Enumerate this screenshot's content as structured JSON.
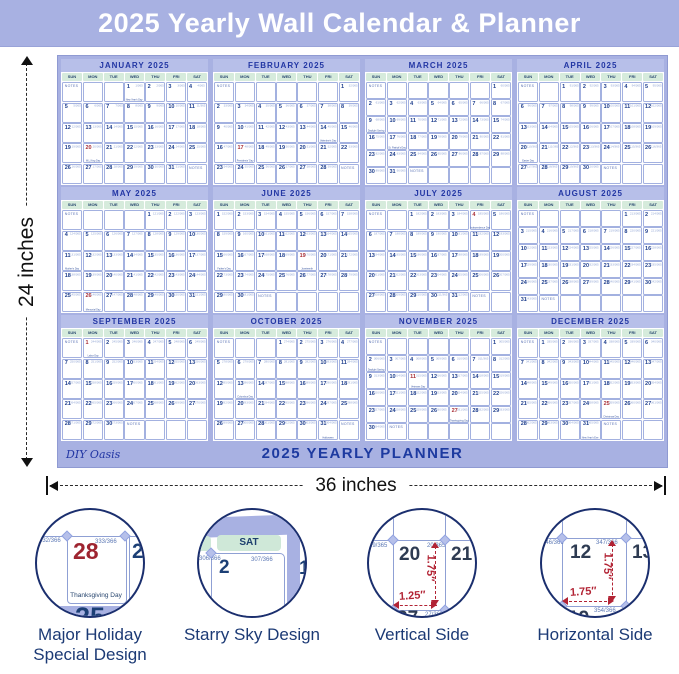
{
  "header": {
    "title": "2025 Yearly Wall Calendar & Planner"
  },
  "poster": {
    "brand": "DIY Oasis",
    "footer": "2025 YEARLY PLANNER",
    "notes_label": "NOTES",
    "year_days": 365,
    "day_headers": [
      "SUN",
      "MON",
      "TUE",
      "WED",
      "THU",
      "FRI",
      "SAT"
    ],
    "months": [
      {
        "label": "JANUARY 2025",
        "days": 31,
        "start": 3,
        "red": [
          20
        ],
        "holidays": {
          "1": "New Year's Day",
          "20": "M.L.King Day"
        }
      },
      {
        "label": "FEBRUARY 2025",
        "days": 28,
        "start": 6,
        "red": [
          17
        ],
        "holidays": {
          "14": "Valentine's Day",
          "17": "Presidents' Day"
        }
      },
      {
        "label": "MARCH 2025",
        "days": 31,
        "start": 6,
        "red": [],
        "holidays": {
          "9": "Daylight Saving",
          "17": "St. Patrick's Day"
        }
      },
      {
        "label": "APRIL 2025",
        "days": 30,
        "start": 2,
        "red": [],
        "holidays": {
          "20": "Easter Day"
        }
      },
      {
        "label": "MAY 2025",
        "days": 31,
        "start": 4,
        "red": [
          26
        ],
        "holidays": {
          "11": "Mother's Day",
          "26": "Memorial Day"
        }
      },
      {
        "label": "JUNE 2025",
        "days": 30,
        "start": 0,
        "red": [
          19
        ],
        "holidays": {
          "15": "Father's Day",
          "19": "Juneteenth"
        }
      },
      {
        "label": "JULY 2025",
        "days": 31,
        "start": 2,
        "red": [
          4
        ],
        "holidays": {
          "4": "Independence Day"
        }
      },
      {
        "label": "AUGUST 2025",
        "days": 31,
        "start": 5,
        "red": [],
        "holidays": {}
      },
      {
        "label": "SEPTEMBER 2025",
        "days": 30,
        "start": 1,
        "red": [
          1
        ],
        "holidays": {
          "1": "Labor Day"
        }
      },
      {
        "label": "OCTOBER 2025",
        "days": 31,
        "start": 3,
        "red": [],
        "holidays": {
          "13": "Columbus Day",
          "31": "Halloween"
        }
      },
      {
        "label": "NOVEMBER 2025",
        "days": 30,
        "start": 6,
        "red": [
          11,
          27
        ],
        "holidays": {
          "2": "Daylight Saving",
          "11": "Veterans Day",
          "27": "Thanksgiving Day"
        }
      },
      {
        "label": "DECEMBER 2025",
        "days": 31,
        "start": 1,
        "red": [
          25
        ],
        "holidays": {
          "25": "Christmas Day",
          "31": "New Year's Eve"
        }
      }
    ]
  },
  "dimensions": {
    "width_label": "36 inches",
    "height_label": "24 inches"
  },
  "features": [
    {
      "label_lines": [
        "Major Holiday",
        "Special Design"
      ],
      "content": {
        "frac_left": "332/366",
        "frac_right": "333/366",
        "red_day": "28",
        "next_day": "29",
        "holiday": "Thanksgiving Day",
        "partial_day": "25"
      }
    },
    {
      "label_lines": [
        "Starry Sky Design"
      ],
      "content": {
        "day_pill": "SAT",
        "main_day": "2",
        "partial_day": "1",
        "frac_left": "306/366",
        "frac_right": "307/366",
        "frac_bottom": "304/366"
      }
    },
    {
      "label_lines": [
        "Vertical Side"
      ],
      "content": {
        "day_tl": "20",
        "day_tr": "21",
        "day_bl": "27",
        "frac_a": "19/365",
        "frac_b": "20/365",
        "frac_c": "27/365",
        "height_label": "1.75″",
        "width_label": "1.25″"
      }
    },
    {
      "label_lines": [
        "Horizontal Side"
      ],
      "content": {
        "day_tl": "12",
        "day_tr": "13",
        "day_bl": "19",
        "frac_a": "346/366",
        "frac_b": "347/366",
        "frac_c": "354/366",
        "height_label": "1.75″",
        "width_label": "1.75″"
      }
    }
  ],
  "colors": {
    "accent_periwinkle": "#a8b1e2",
    "title_navy": "#1d3aa0",
    "holiday_red": "#a93038",
    "mint_day_header": "#d6ebdc"
  }
}
